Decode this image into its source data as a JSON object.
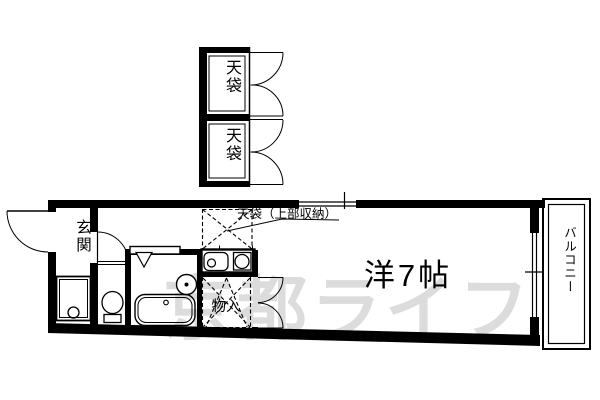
{
  "floor_plan": {
    "labels": {
      "tenbukuro_top": "天袋",
      "tenbukuro_bottom": "天袋",
      "tenbukuro_note": "天袋（上部収納）",
      "genkan": "玄関",
      "main_room": "洋7帖",
      "monoire": "物入",
      "balcony": "バルコニー"
    },
    "watermark": "京都ライフ",
    "colors": {
      "line": "#000000",
      "background": "#ffffff",
      "watermark": "#dcdcdc"
    }
  }
}
